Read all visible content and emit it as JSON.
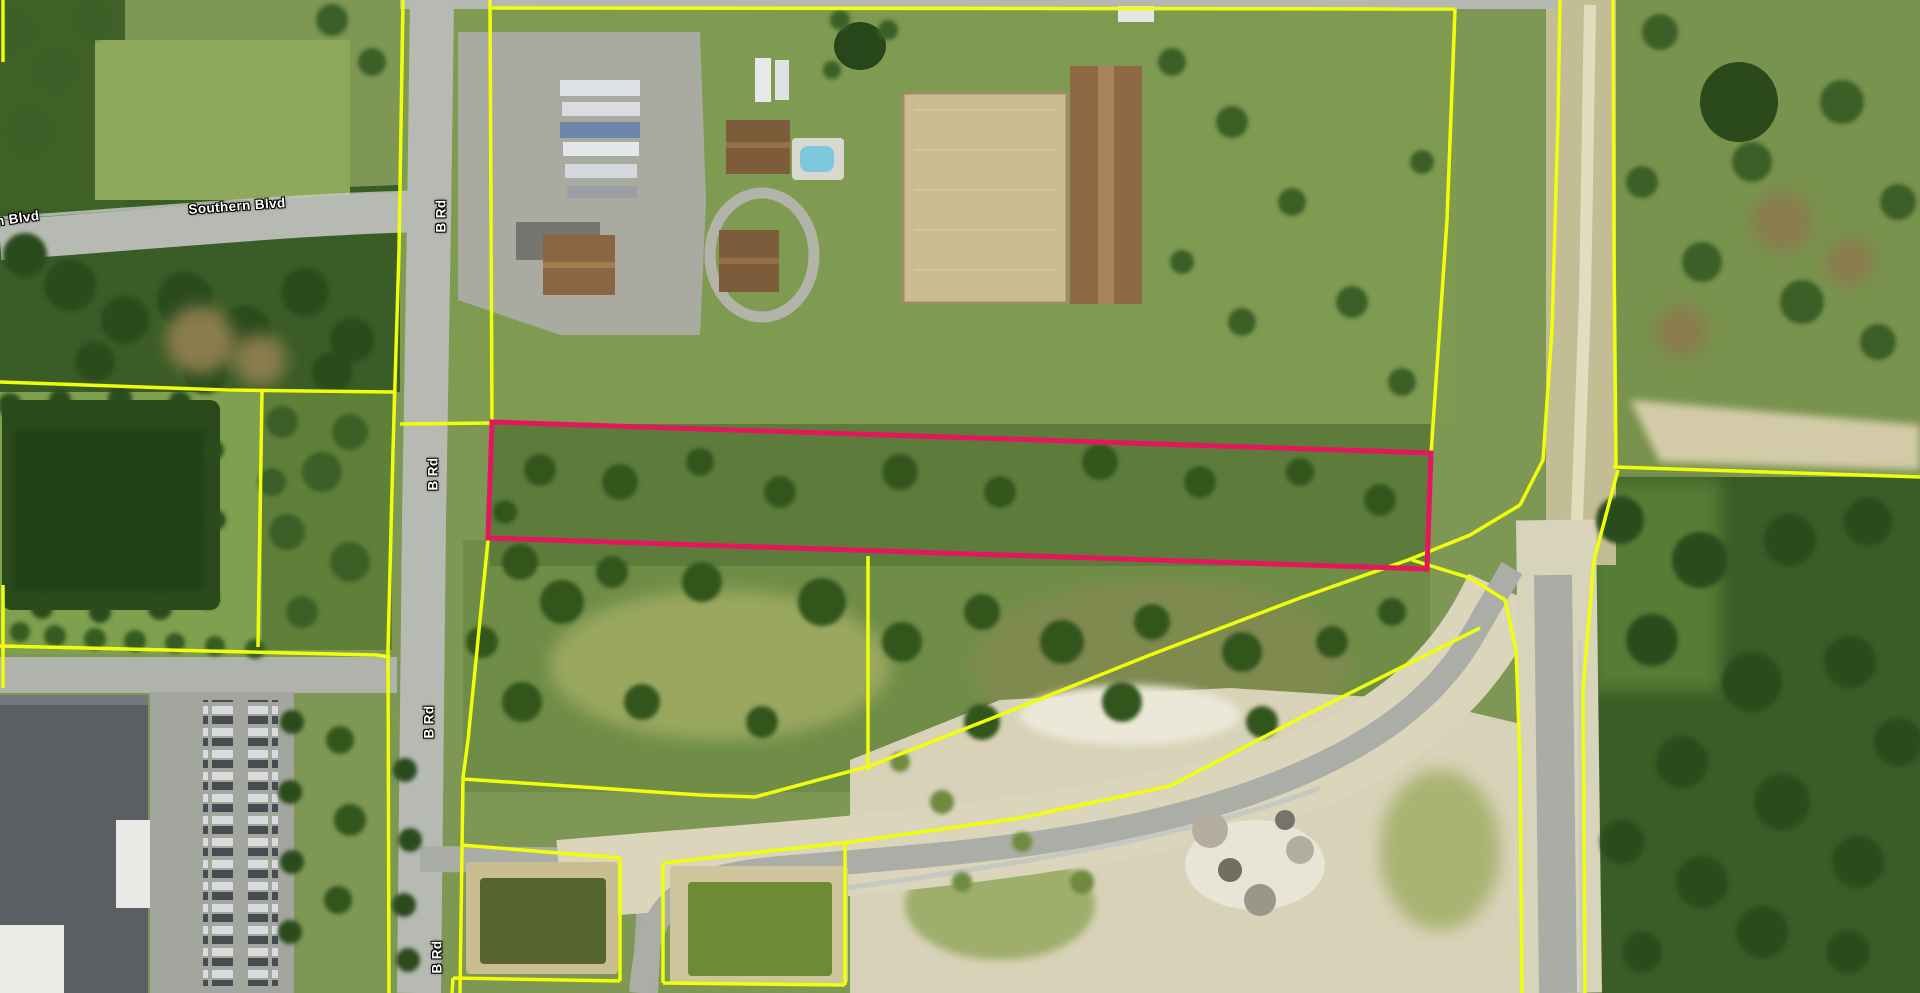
{
  "map": {
    "description": "Aerial parcel map with one highlighted parcel outlined in magenta; surrounding parcels outlined in yellow",
    "colors": {
      "parcel_line": "#F0FF0A",
      "selected_parcel": "#E4175C",
      "label_text": "#FFFFFF",
      "label_halo": "#000000"
    },
    "road_labels": [
      {
        "text": "Southern Blvd",
        "x": 237,
        "y": 206,
        "rotation": -4
      },
      {
        "text": "Southern Blvd",
        "x": -9,
        "y": 222,
        "rotation": -8
      },
      {
        "text": "B Rd",
        "x": 441,
        "y": 216,
        "rotation": -90
      },
      {
        "text": "B Rd",
        "x": 433,
        "y": 474,
        "rotation": -90
      },
      {
        "text": "B Rd",
        "x": 429,
        "y": 722,
        "rotation": -90
      },
      {
        "text": "B Rd",
        "x": 437,
        "y": 957,
        "rotation": -90
      }
    ],
    "selected_parcel": {
      "stroke_width": 5,
      "points": [
        [
          492,
          422
        ],
        [
          1431,
          453
        ],
        [
          1427,
          569
        ],
        [
          488,
          538
        ]
      ]
    },
    "parcel_line_stroke_width": 3.5,
    "parcel_lines": [
      {
        "points": [
          [
            403,
            0
          ],
          [
            399,
            250
          ],
          [
            393,
            450
          ],
          [
            388,
            650
          ],
          [
            389,
            993
          ]
        ]
      },
      {
        "points": [
          [
            0,
            382
          ],
          [
            227,
            390
          ],
          [
            394,
            392
          ]
        ]
      },
      {
        "points": [
          [
            262,
            392
          ],
          [
            258,
            647
          ]
        ]
      },
      {
        "points": [
          [
            0,
            646
          ],
          [
            377,
            655
          ],
          [
            390,
            657
          ]
        ]
      },
      {
        "points": [
          [
            3,
            585
          ],
          [
            3,
            688
          ]
        ]
      },
      {
        "points": [
          [
            3,
            0
          ],
          [
            3,
            62
          ]
        ]
      },
      {
        "points": [
          [
            490,
            0
          ],
          [
            492,
            422
          ]
        ]
      },
      {
        "points": [
          [
            490,
            8
          ],
          [
            1455,
            9
          ]
        ]
      },
      {
        "points": [
          [
            1455,
            9
          ],
          [
            1447,
            220
          ],
          [
            1432,
            440
          ],
          [
            1431,
            453
          ]
        ]
      },
      {
        "points": [
          [
            400,
            424
          ],
          [
            492,
            423
          ]
        ]
      },
      {
        "points": [
          [
            488,
            540
          ],
          [
            468,
            740
          ],
          [
            463,
            778
          ],
          [
            460,
            993
          ]
        ]
      },
      {
        "points": [
          [
            463,
            779
          ],
          [
            700,
            795
          ],
          [
            755,
            797
          ],
          [
            870,
            766
          ],
          [
            1000,
            715
          ],
          [
            1150,
            655
          ],
          [
            1300,
            598
          ],
          [
            1408,
            560
          ],
          [
            1470,
            535
          ],
          [
            1520,
            505
          ],
          [
            1543,
            460
          ],
          [
            1552,
            330
          ],
          [
            1558,
            120
          ],
          [
            1560,
            0
          ]
        ]
      },
      {
        "points": [
          [
            1412,
            560
          ],
          [
            1470,
            578
          ],
          [
            1505,
            600
          ],
          [
            1516,
            650
          ],
          [
            1520,
            760
          ],
          [
            1522,
            993
          ]
        ]
      },
      {
        "points": [
          [
            663,
            863
          ],
          [
            850,
            842
          ],
          [
            1020,
            818
          ],
          [
            1170,
            786
          ],
          [
            1300,
            718
          ],
          [
            1400,
            668
          ],
          [
            1480,
            628
          ]
        ]
      },
      {
        "points": [
          [
            1613,
            0
          ],
          [
            1614,
            250
          ],
          [
            1616,
            467
          ]
        ]
      },
      {
        "points": [
          [
            1613,
            467
          ],
          [
            1920,
            477
          ]
        ]
      },
      {
        "points": [
          [
            1618,
            470
          ],
          [
            1594,
            560
          ],
          [
            1583,
            690
          ],
          [
            1585,
            993
          ]
        ]
      },
      {
        "points": [
          [
            461,
            845
          ],
          [
            620,
            858
          ]
        ]
      },
      {
        "points": [
          [
            620,
            858
          ],
          [
            620,
            981
          ]
        ]
      },
      {
        "points": [
          [
            453,
            978
          ],
          [
            620,
            981
          ]
        ]
      },
      {
        "points": [
          [
            453,
            978
          ],
          [
            452,
            993
          ]
        ]
      },
      {
        "points": [
          [
            663,
            864
          ],
          [
            663,
            983
          ]
        ]
      },
      {
        "points": [
          [
            663,
            983
          ],
          [
            845,
            985
          ]
        ]
      },
      {
        "points": [
          [
            845,
            843
          ],
          [
            845,
            985
          ]
        ]
      },
      {
        "points": [
          [
            868,
            556
          ],
          [
            868,
            770
          ]
        ]
      }
    ]
  }
}
